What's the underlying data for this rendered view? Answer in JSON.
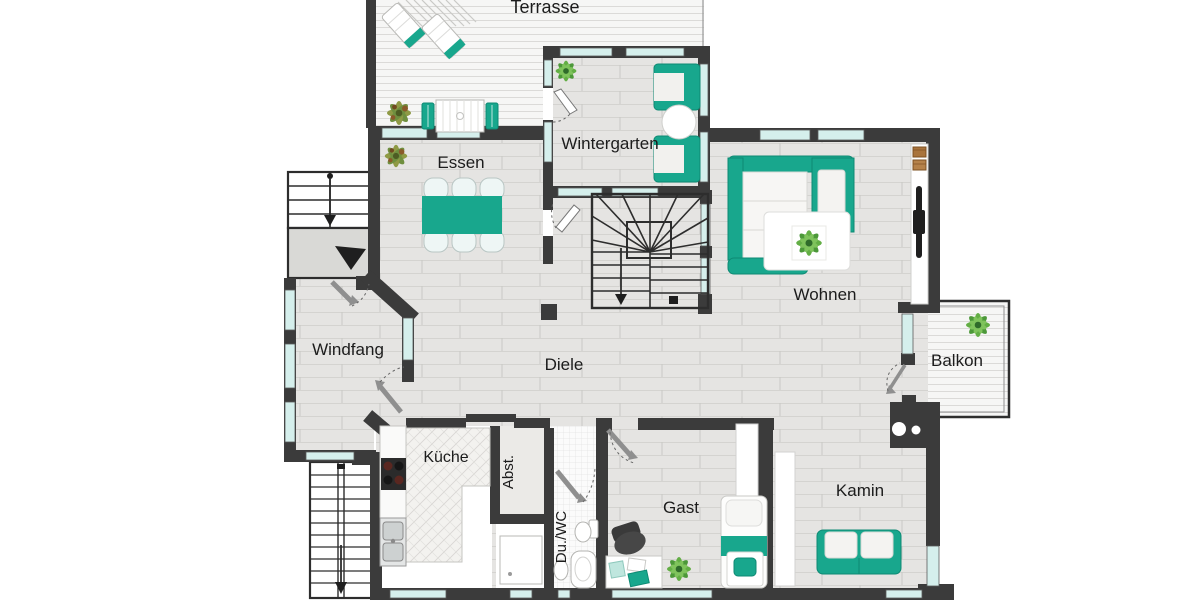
{
  "plan": {
    "type": "residential floor plan",
    "labels": {
      "terrasse": "Terrasse",
      "wintergarten": "Wintergarten",
      "essen": "Essen",
      "wohnen": "Wohnen",
      "windfang": "Windfang",
      "diele": "Diele",
      "balkon": "Balkon",
      "kueche": "Küche",
      "abst": "Abst.",
      "duwc": "Du./WC",
      "gast": "Gast",
      "kamin": "Kamin"
    },
    "colors": {
      "accent_teal": "#18A78D",
      "wall": "#3B3B3B",
      "window_glass": "#D5EFEC",
      "floor_gray": "#E5E4E2",
      "deck_white": "#F6F6F5",
      "plant_green": "#67B346",
      "label_text": "#1C1C1C"
    }
  }
}
